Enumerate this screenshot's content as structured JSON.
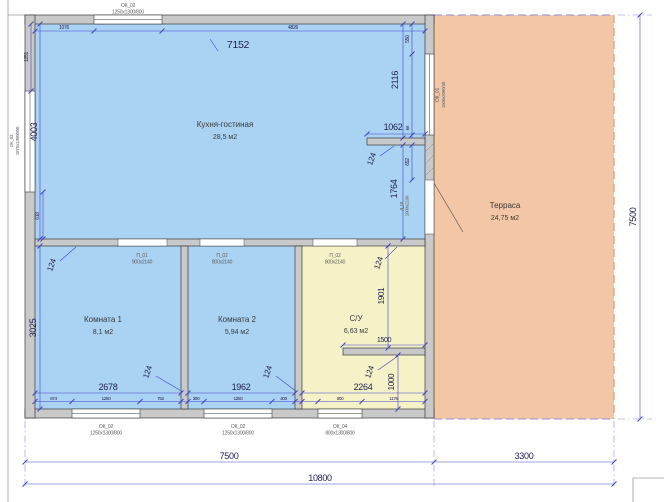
{
  "meta": {
    "type": "architectural floor plan"
  },
  "colors": {
    "room_fill": "#aad2f2",
    "bath_fill": "#f5f2c8",
    "terrace_fill": "#f3c7a6",
    "wall_fill": "#c9c9c9",
    "dim": "#4343c6",
    "ext": "#8d8de0"
  },
  "rooms": {
    "kitchen": {
      "name": "Кухня-гостиная",
      "area": "28,5 м2"
    },
    "room1": {
      "name": "Комната 1",
      "area": "8,1 м2"
    },
    "room2": {
      "name": "Комната 2",
      "area": "5,94 м2"
    },
    "bath": {
      "name": "С/У",
      "area": "6,63 м2"
    },
    "terrace": {
      "name": "Терраса",
      "area": "24,75 м2"
    }
  },
  "openings": {
    "ok01": {
      "code": "ОК_01",
      "size": "1500x2060/40"
    },
    "ok02": {
      "code": "ОК_02",
      "size": "1250x1300/800"
    },
    "ok03": {
      "code": "ОК_03",
      "size": "1875x1300/800"
    },
    "ok04": {
      "code": "ОК_04",
      "size": "800x1300/800"
    },
    "d01": {
      "code": "Д_01",
      "size": "1000x2100"
    },
    "p01": {
      "code": "П_01",
      "size": "900x2140"
    },
    "p02": {
      "code": "П_02",
      "size": "800x2140"
    }
  },
  "dims": {
    "total_w": "10800",
    "house_w": "7500",
    "terrace_w": "3300",
    "total_h": "7500",
    "kitchen_w": "7152",
    "kitchen_h": "4003",
    "rooms_h": "3025",
    "top_left": "1076",
    "top_right": "4826",
    "left_top": "1251",
    "left_bottom": "618",
    "right_top": "550",
    "right_win_gap": "66",
    "right_door_gap": "652",
    "stub": "1062",
    "v1": "2116",
    "v2": "1764",
    "t124": "124",
    "room1_w": "2678",
    "room2_w": "1962",
    "bath_w": "2264",
    "bath_shelf": "1500",
    "bath_top_h": "1901",
    "bath_bottom_h": "1000",
    "b1": "674",
    "b2": "1250",
    "b3": "752",
    "b4": "300",
    "b5": "1250",
    "b6": "400",
    "b7": "800",
    "b8": "1176"
  }
}
